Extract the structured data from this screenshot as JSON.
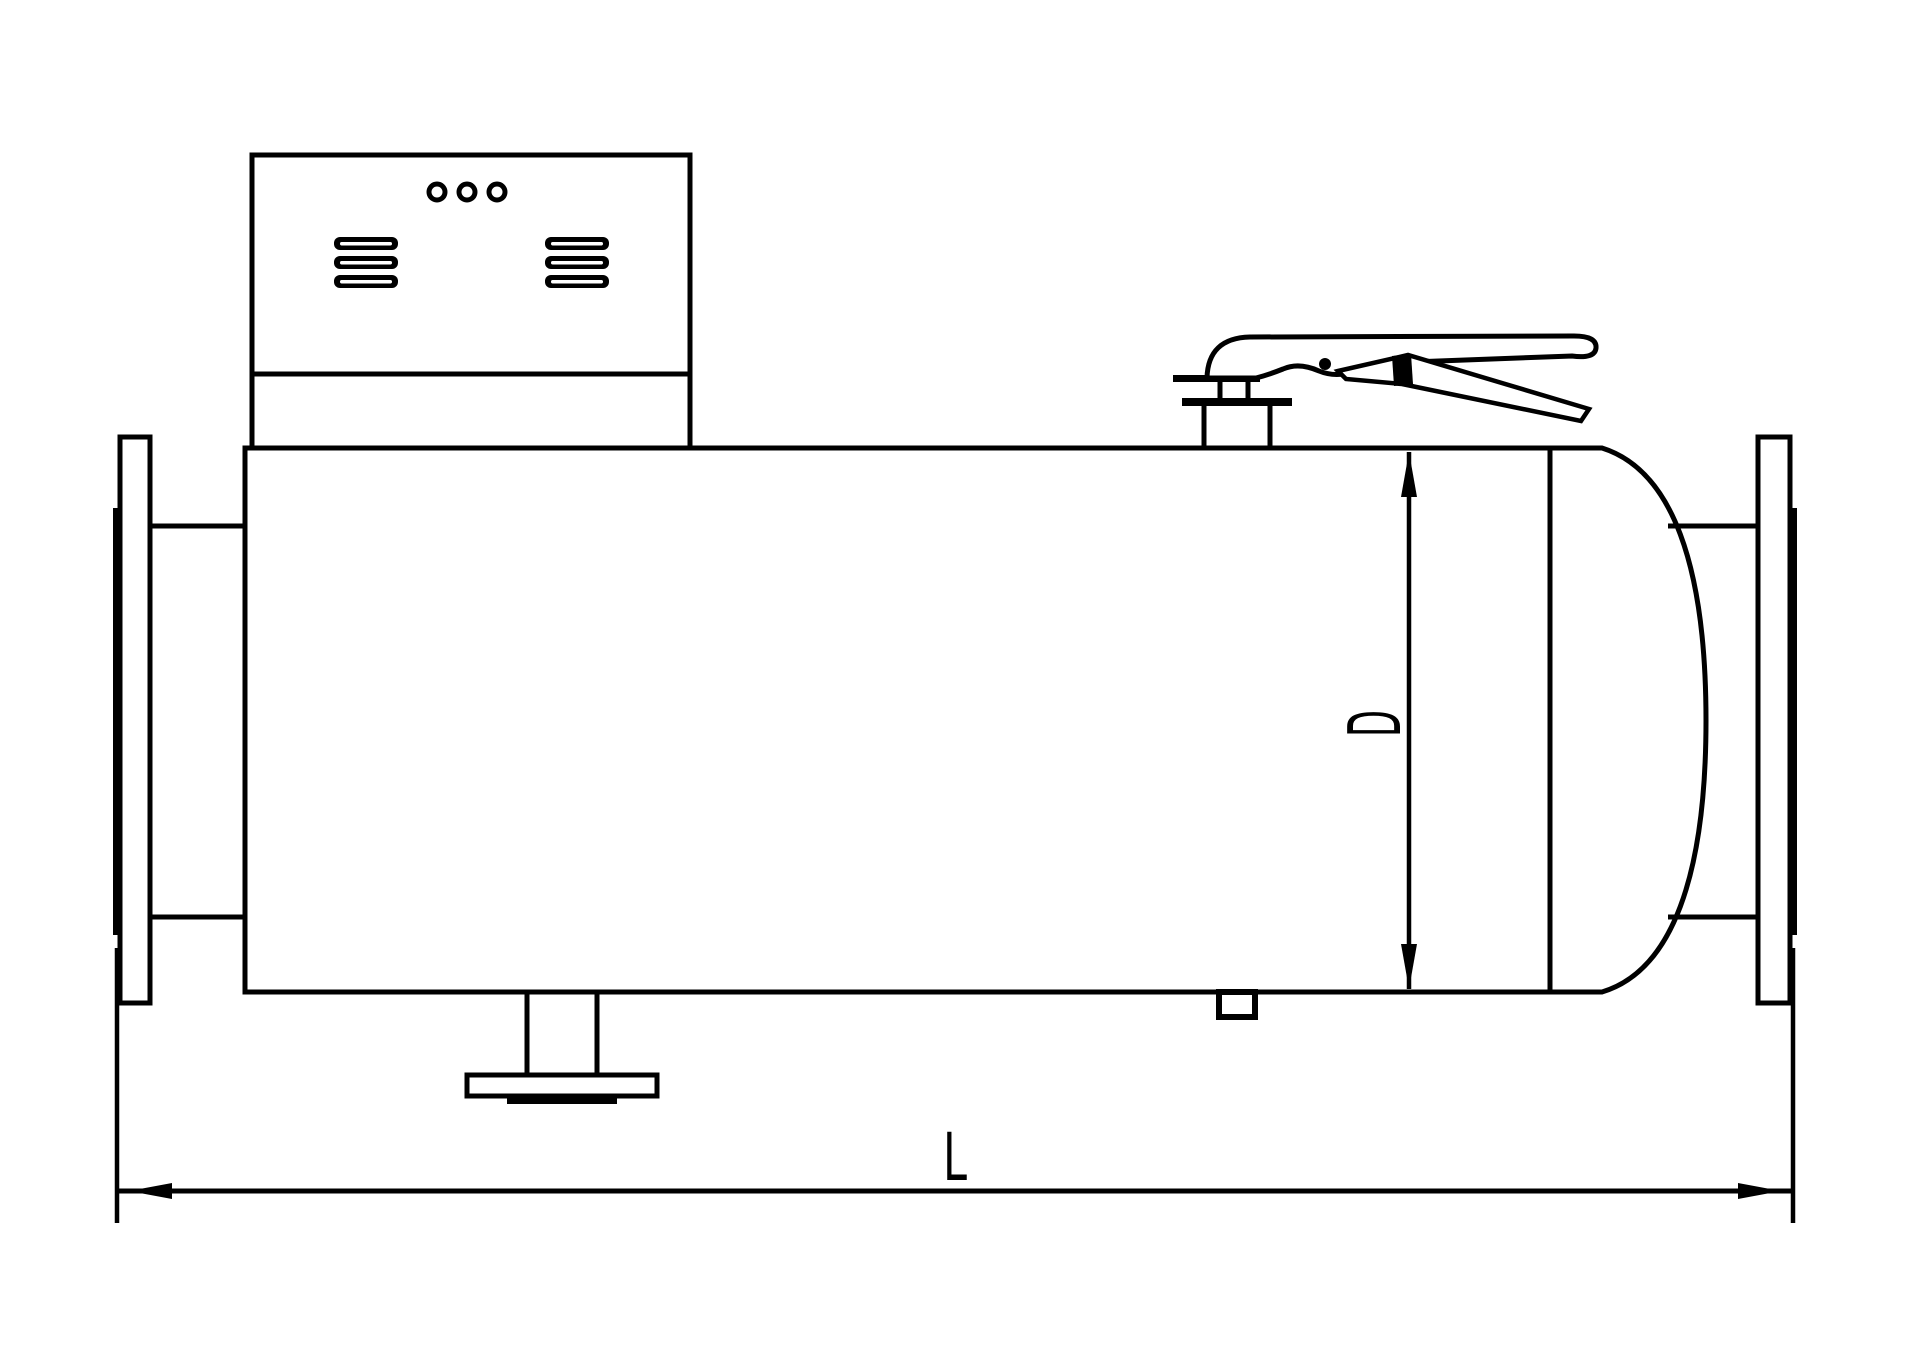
{
  "drawing": {
    "type": "engineering-line-drawing",
    "subject": "horizontal flanged vessel / pipeline heater side view",
    "background_color": "#ffffff",
    "line_color": "#000000",
    "labels": {
      "diameter": "D",
      "length": "L"
    },
    "parts": [
      "control-box",
      "vent-louvers",
      "indicator-dots",
      "vessel-shell",
      "dished-head",
      "left-flange",
      "right-flange",
      "top-nozzle",
      "quick-release-handle",
      "bottom-drain-nozzle",
      "small-plug",
      "dimension-D",
      "dimension-L"
    ]
  }
}
